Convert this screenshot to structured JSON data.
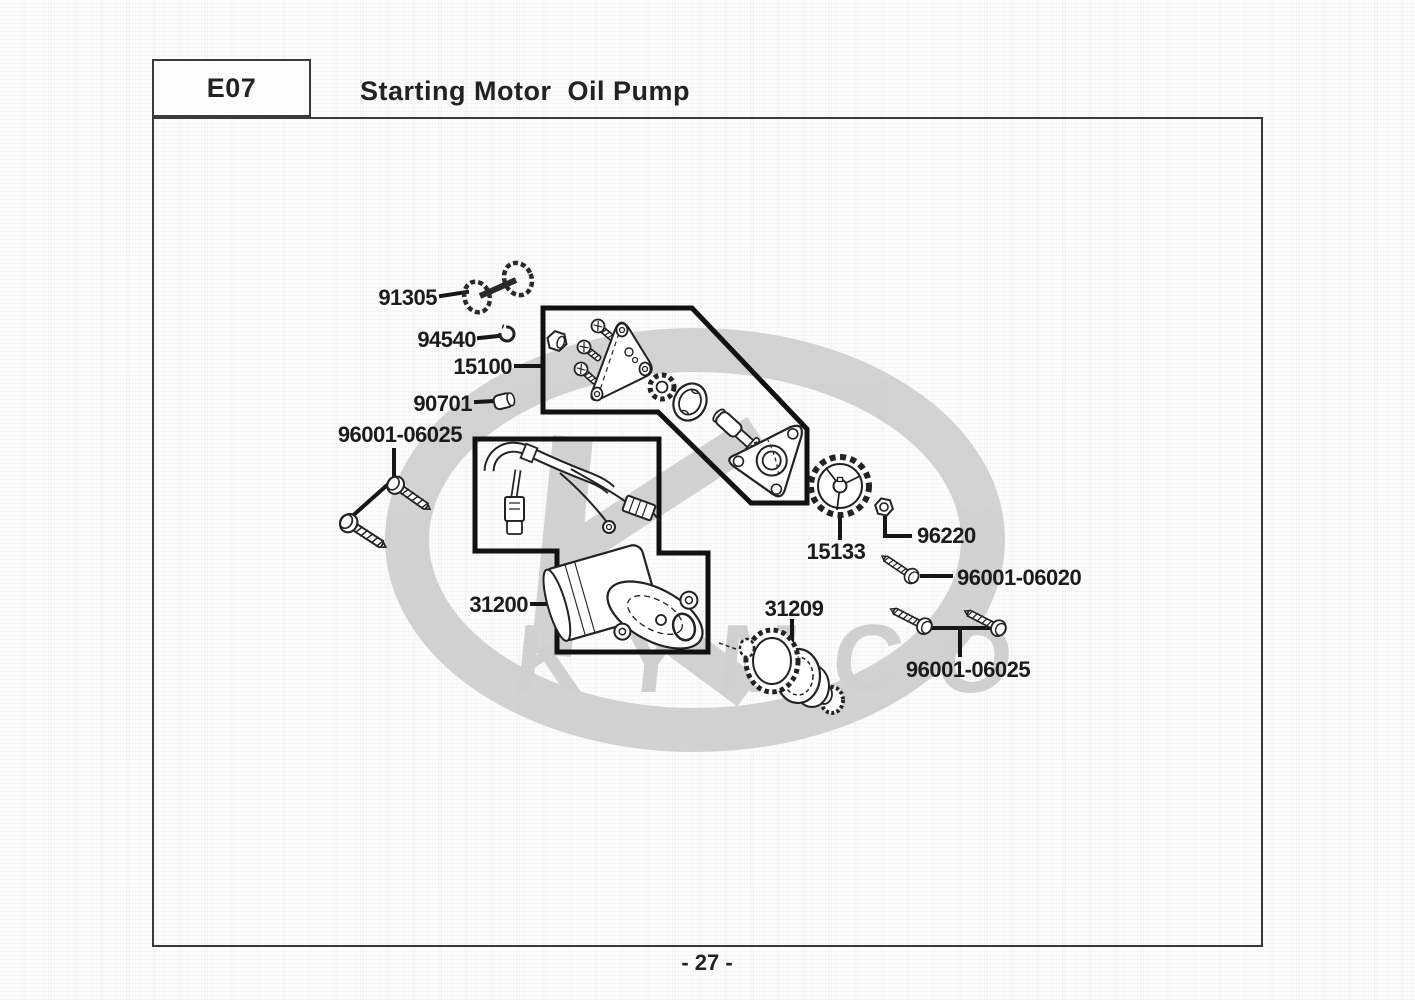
{
  "header": {
    "code": "E07",
    "title": "Starting Motor  Oil Pump"
  },
  "watermark": {
    "text": "KYMCO"
  },
  "footer": {
    "page_number": "- 27 -"
  },
  "parts": [
    {
      "part_number": "91305"
    },
    {
      "part_number": "94540"
    },
    {
      "part_number": "15100"
    },
    {
      "part_number": "90701"
    },
    {
      "part_number": "96001-06025"
    },
    {
      "part_number": "31200"
    },
    {
      "part_number": "15133"
    },
    {
      "part_number": "96220"
    },
    {
      "part_number": "96001-06020"
    },
    {
      "part_number": "31209"
    },
    {
      "part_number": "96001-06025"
    }
  ],
  "colors": {
    "line_art": "#222222",
    "frame": "#3a3a3a",
    "watermark_gray": "#cbcbcb",
    "paper": "#fdfdfd"
  }
}
